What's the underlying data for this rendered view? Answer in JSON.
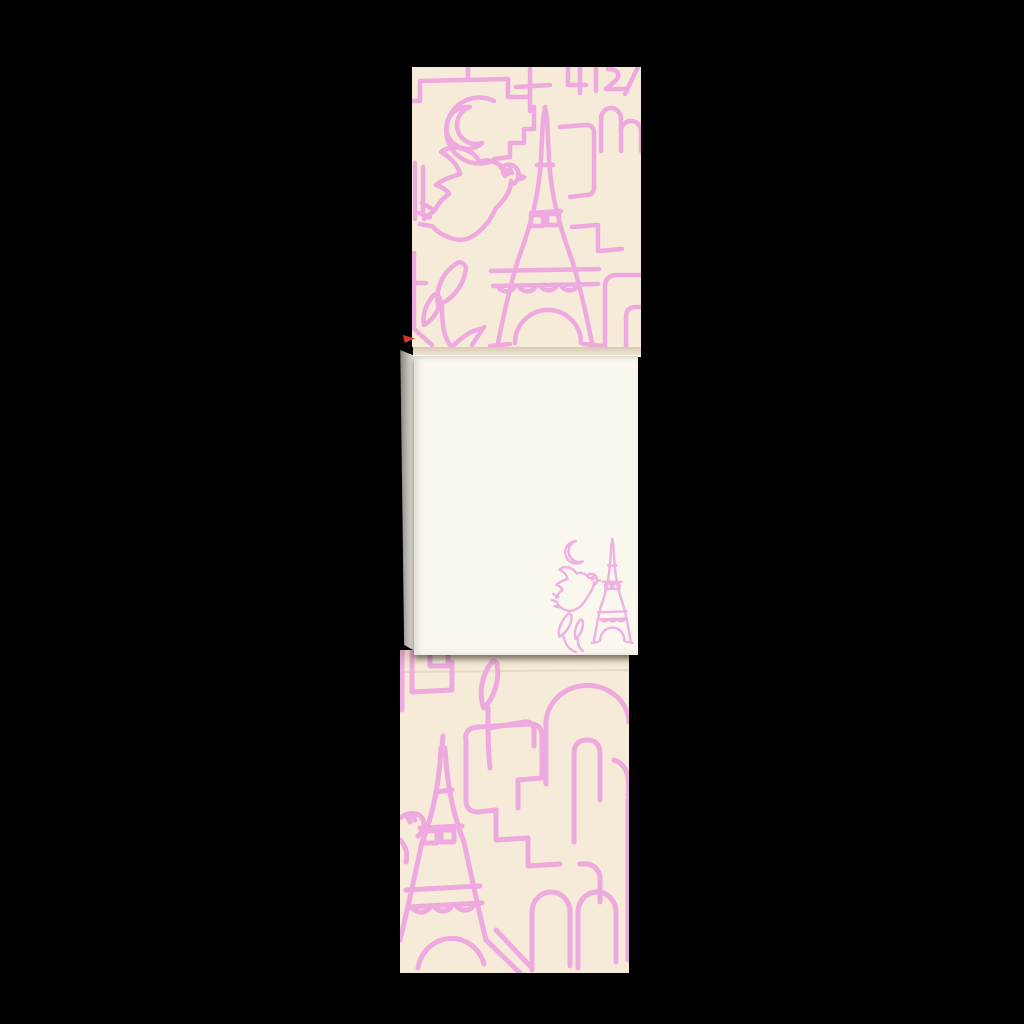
{
  "scene": {
    "type": "product-photo",
    "subject": "paris-themed-notepad",
    "description": "Black backdrop product shot of a notepad: patterned cover sheet at top, open notepad with blank cream page and small corner illustration in the middle, patterned back sheet at the bottom",
    "sections": [
      {
        "name": "cover-sheet-top",
        "label": "Notepad cover with pink Paris line-art pattern"
      },
      {
        "name": "open-notepad",
        "label": "Open notepad showing blank page with corner illustration"
      },
      {
        "name": "back-sheet-bottom",
        "label": "Patterned back sheet behind the notepad"
      }
    ]
  },
  "colors": {
    "backdrop": "#000000",
    "cover_cream": "#f6ead8",
    "pattern_pink": "#eea9de",
    "page_white": "#faf7ef",
    "corner_art_pink": "#eeb2de",
    "paper_edge_gray_dark": "#7d7872",
    "paper_edge_gray_light": "#e9e6e1",
    "underside_cream": "#efe3d2",
    "crease_line": "#e6dac4",
    "accent_red_fleck": "#cf3a2c"
  },
  "motifs": {
    "cover": [
      "crescent-moon",
      "flying-dove",
      "eiffel-tower",
      "leaf-sprig",
      "double-arch",
      "abstract-line-shapes"
    ],
    "page_corner": [
      "crescent-moon",
      "flying-dove",
      "eiffel-tower",
      "leaf-sprig"
    ],
    "back_sheet": [
      "eiffel-tower",
      "dove-head",
      "leaf-sprig",
      "arches",
      "abstract-line-shapes"
    ]
  }
}
